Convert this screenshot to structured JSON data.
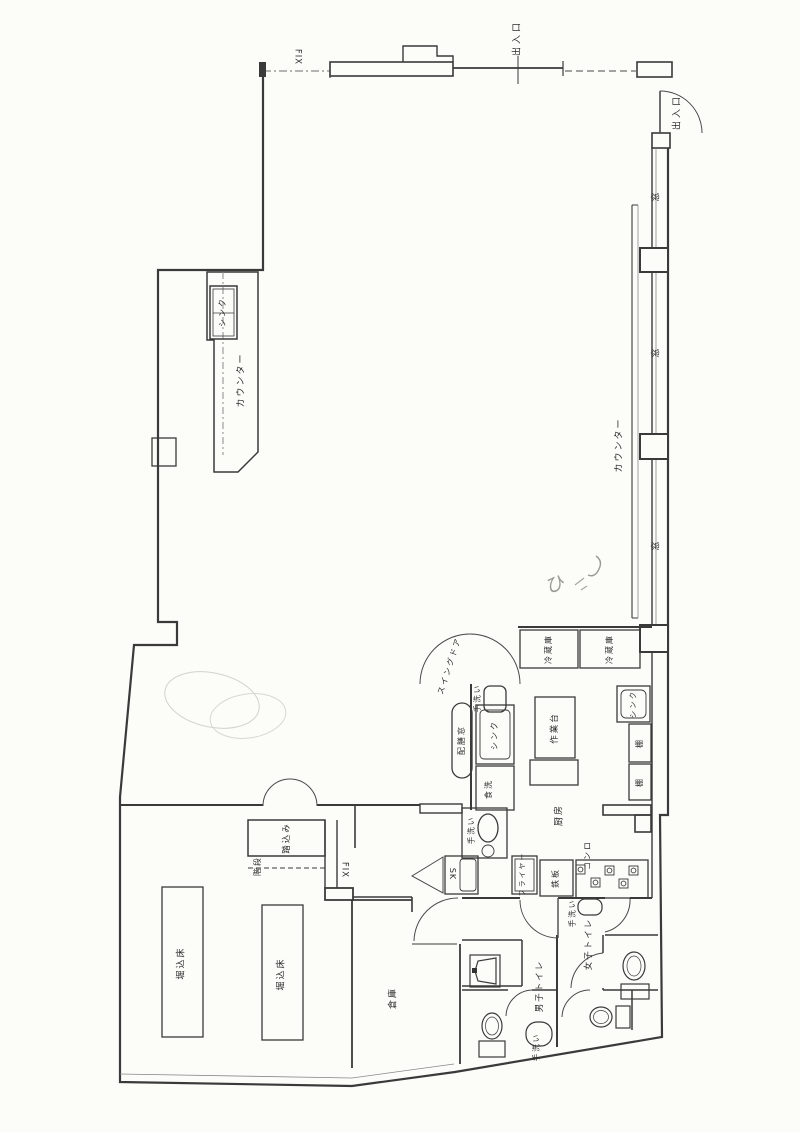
{
  "drawing": {
    "kind": "floor-plan-scan",
    "orientation_note": "labels written rotated for landscape reading"
  },
  "colors": {
    "paper": "#fcfcf9",
    "line": "#3a3a3a",
    "thin_line": "#777777",
    "pencil": "#ccccc5",
    "label": "#2b2b2b"
  },
  "labels": {
    "exit_top": "出入口",
    "exit_right": "出入口",
    "fix_top": "FIX",
    "fix_mid": "FIX",
    "window_1": "窓",
    "window_2": "窓",
    "window_3": "窓",
    "counter_right": "カウンター",
    "counter_left": "カウンター",
    "sink_counter": "シンク",
    "fridge_1": "冷蔵庫",
    "fridge_2": "冷蔵庫",
    "sink_wall": "シンク",
    "shelf_1": "棚",
    "shelf_2": "棚",
    "swing_door": "スイングドア",
    "handwash_top": "手洗い",
    "serving_window": "配膳窓",
    "sink_kitchen": "シンク",
    "dishwasher": "食洗",
    "work_table": "作業台",
    "kitchen": "厨房",
    "handwash_west": "手洗い",
    "sk": "SK",
    "fryer": "フライヤー",
    "griddle": "鉄板",
    "stove": "コンロ",
    "handwash_anteroom": "手洗い",
    "womens_toilet": "女子トイレ",
    "mens_toilet": "男子トイレ",
    "handwash_mens": "手洗い",
    "storage": "倉庫",
    "sunken_floor_1": "堀込床",
    "sunken_floor_2": "堀込床",
    "entry_step": "踏込み",
    "stairs": "階段",
    "handwritten_mark": "ひ"
  }
}
